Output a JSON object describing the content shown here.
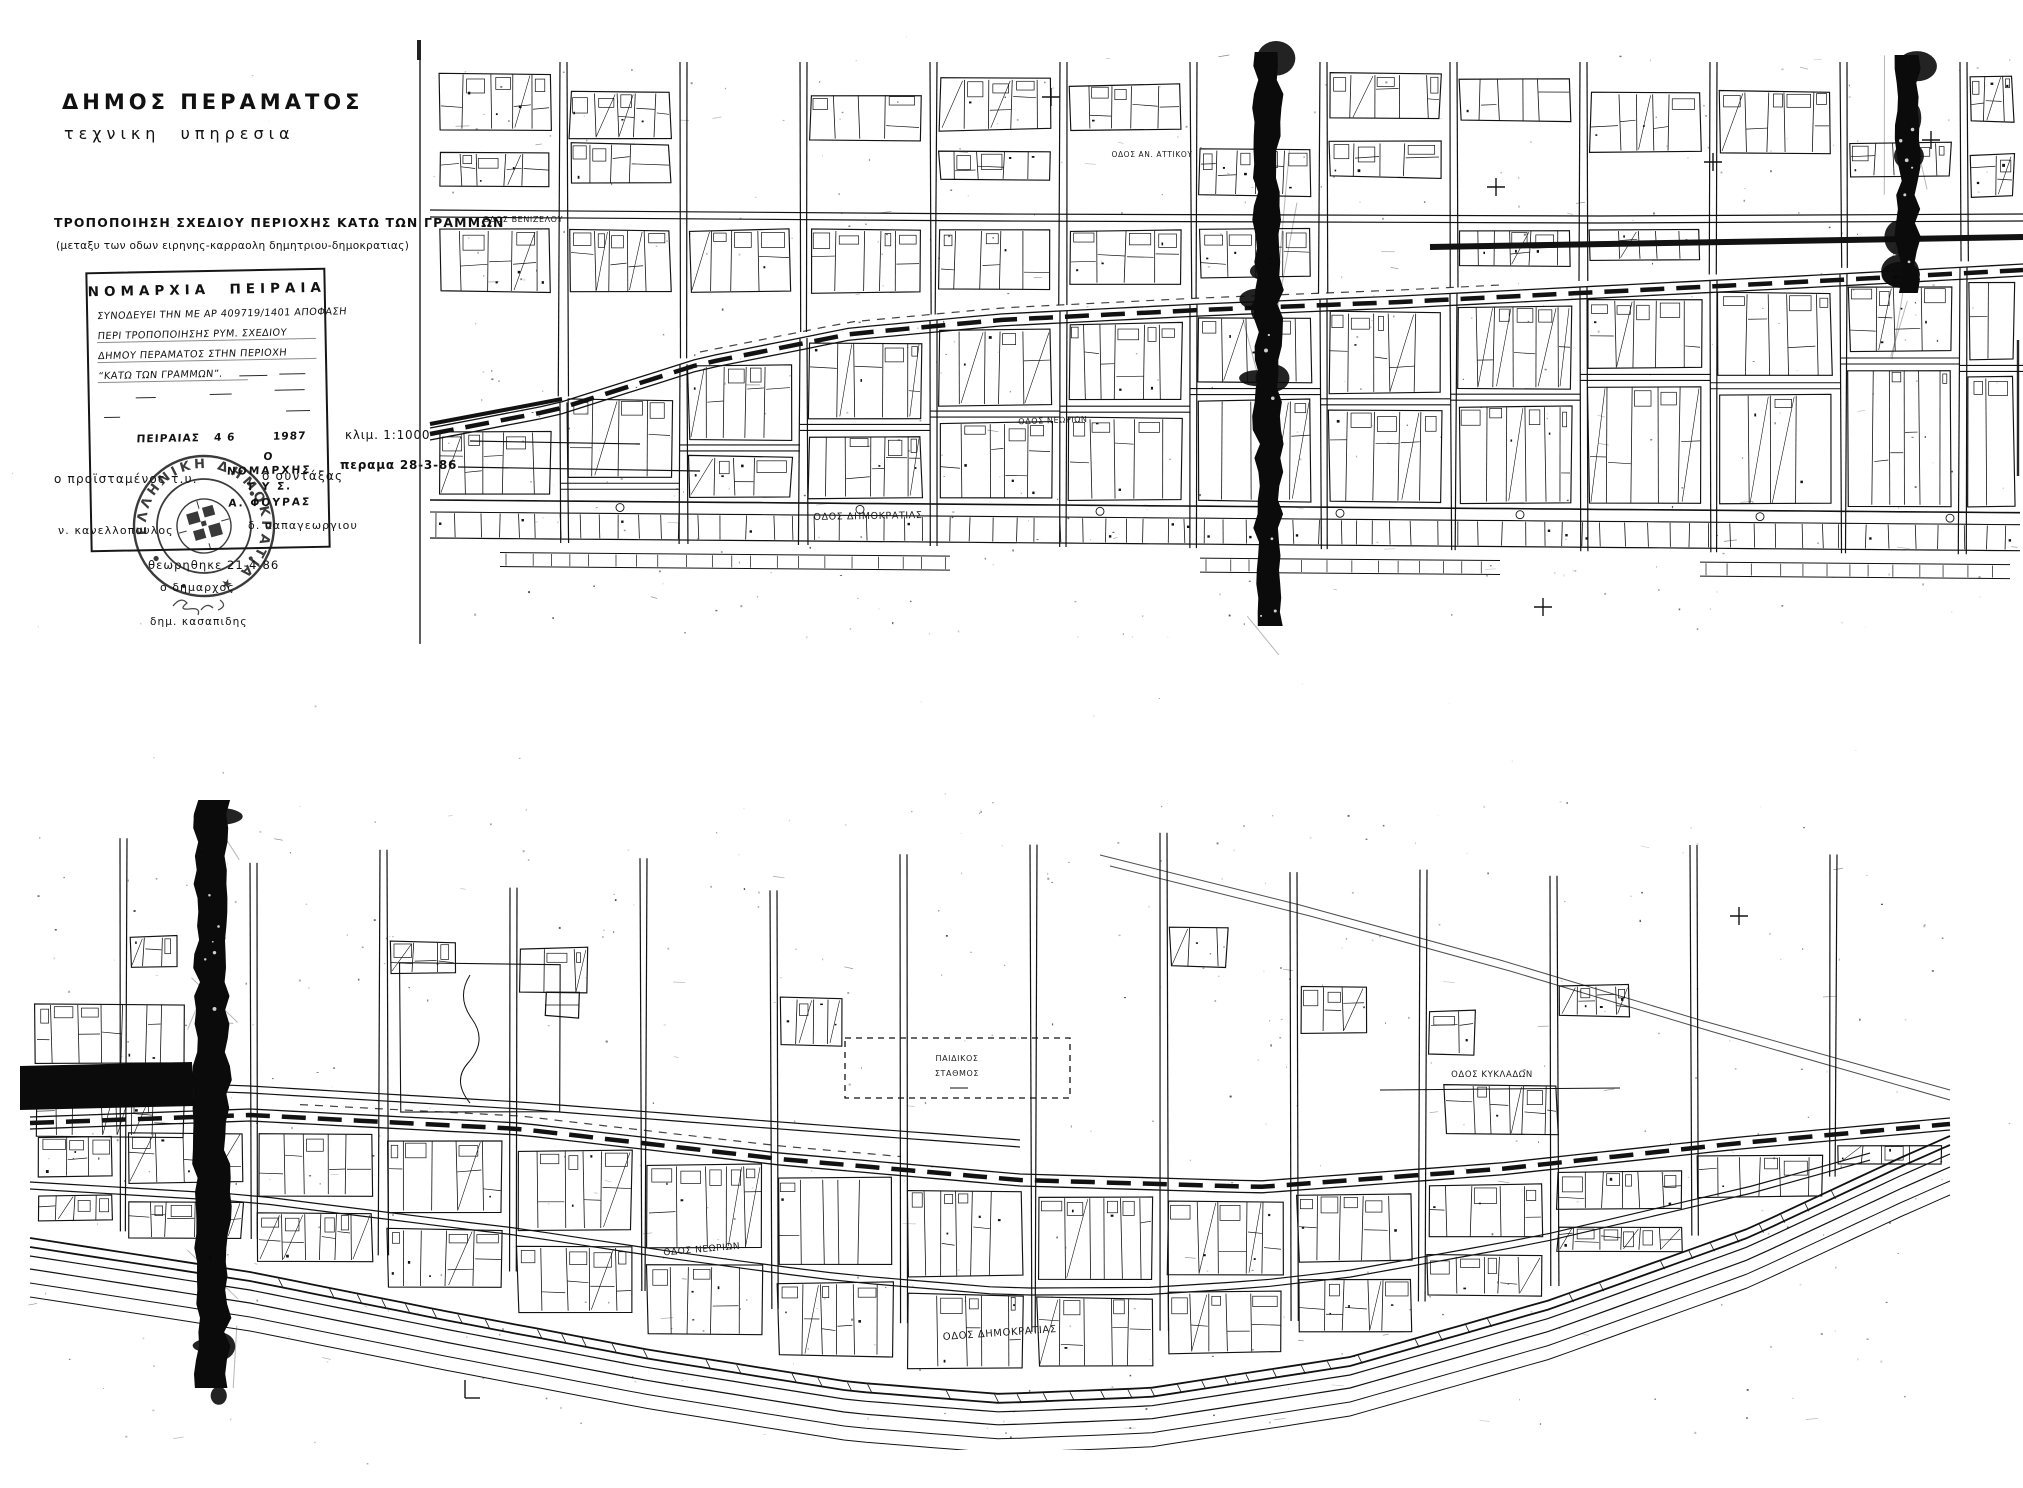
{
  "header": {
    "municipality": "ΔΗΜΟΣ ΠΕΡΑΜΑΤΟΣ",
    "department": "τεχνικη  υπηρεσια"
  },
  "title_block": {
    "title": "ΤΡΟΠΟΠΟΙΗΣΗ ΣΧΕΔΙΟΥ ΠΕΡΙΟΧΗΣ ΚΑΤΩ ΤΩΝ ΓΡΑΜΜΩΝ",
    "subtitle": "(μεταξυ των οδων ειρηνης-καρραολη δημητριου-δημοκρατιας)"
  },
  "approval_box": {
    "authority": "ΝΟΜΑΡΧΙΑ  ΠΕΙΡΑΙΑ",
    "line1": "ΣΥΝΟΔΕΥΕΙ ΤΗΝ ΜΕ ΑΡ 409719/1401 ΑΠΟΦΑΣΗ",
    "line2": "ΠΕΡΙ ΤΡΟΠΟΠΟΙΗΣΗΣ ΡΥΜ. ΣΧΕΔΙΟΥ",
    "line3": "ΔΗΜΟΥ ΠΕΡΑΜΑΤΟΣ ΣΤΗΝ ΠΕΡΙΟΧΗ",
    "line4": "“ΚΑΤΩ ΤΩΝ ΓΡΑΜΜΩΝ”.",
    "place_date": "ΠΕΙΡΑΙΑΣ   4 6        1987",
    "sig_o": "Ο",
    "sig_role": "ΝΟΜΑΡΧΗΣ",
    "sig_tys": "Τ Υ Σ.",
    "sig_name": "Α. ΦΟΥΡΑΣ",
    "stamp_text": "ΕΛΛΗΝΙΚΗ ΔΗΜΟΚΡΑΤΙΑ ★"
  },
  "scale_block": {
    "scale": "κλιμ. 1:1000",
    "place_date": "περαμα 28-3-86"
  },
  "signatures": {
    "left_role": "ο προϊσταμένος τ.υ.",
    "right_role": "ο συντάξας",
    "left_name": "ν. κανελλοπουλος",
    "right_name": "δ. παπαγεωργιου",
    "reviewed": "θεωρηθηκε 21-4-86",
    "mayor_role": "ο δημαρχος",
    "mayor_name": "δημ. κασαπιδης"
  },
  "colors": {
    "ink": "#121212",
    "paper": "#ffffff"
  },
  "maps": {
    "top": {
      "labels": [
        {
          "text": "ΟΔΟΣ ΒΕΝΙΖΕΛΟΥ",
          "x": 523,
          "y": 222,
          "r": 0,
          "s": 8
        },
        {
          "text": "ΟΔΟΣ ΑΝ. ΑΤΤΙΚΟΥ",
          "x": 1152,
          "y": 157,
          "r": 0,
          "s": 7.5
        },
        {
          "text": "ΟΔΟΣ ΝΕΩΡΙΩΝ",
          "x": 1053,
          "y": 423,
          "r": -2,
          "s": 8
        },
        {
          "text": "ΟΔΟΣ ΔΗΜΟΚΡΑΤΙΑΣ",
          "x": 868,
          "y": 519,
          "r": -1,
          "s": 9.5
        }
      ]
    },
    "bottom": {
      "labels": [
        {
          "text": "ΟΔΟΣ ΚΥΚΛΑΔΩΝ",
          "x": 1492,
          "y": 1077,
          "r": 0,
          "s": 8.5
        },
        {
          "text": "ΠΑΙΔΙΚΟΣ",
          "x": 957,
          "y": 1061,
          "r": 0,
          "s": 8
        },
        {
          "text": "ΣΤΑΘΜΟΣ",
          "x": 957,
          "y": 1076,
          "r": 0,
          "s": 8
        },
        {
          "text": "ΟΔΟΣ ΝΕΩΡΙΩΝ",
          "x": 702,
          "y": 1252,
          "r": -5,
          "s": 9
        },
        {
          "text": "ΟΔΟΣ ΔΗΜΟΚΡΑΤΙΑΣ",
          "x": 1000,
          "y": 1336,
          "r": -4,
          "s": 10
        }
      ]
    }
  }
}
